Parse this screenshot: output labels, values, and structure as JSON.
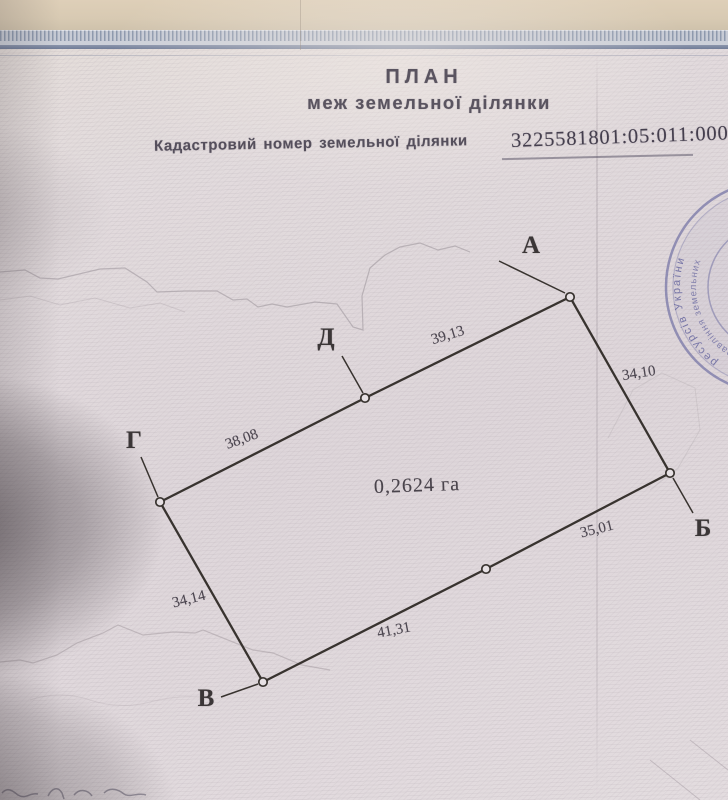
{
  "document": {
    "title_line1": "ПЛАН",
    "title_line2": "меж земельної ділянки",
    "cadastral_label": "Кадастровий номер земельної ділянки",
    "cadastral_number": "3225581801:05:011:0006"
  },
  "plan": {
    "area_label": "0,2624 га",
    "points": {
      "a": "А",
      "b": "Б",
      "v": "В",
      "g": "Г",
      "d": "Д"
    },
    "dimensions": {
      "da": "39,13",
      "ab": "34,10",
      "gd": "38,08",
      "b_mid": "35,01",
      "mid_v": "41,31",
      "v_g": "34,14"
    }
  },
  "stamp": {
    "outer_text": "ресурсів України",
    "inner_text": "управління земельних"
  }
}
